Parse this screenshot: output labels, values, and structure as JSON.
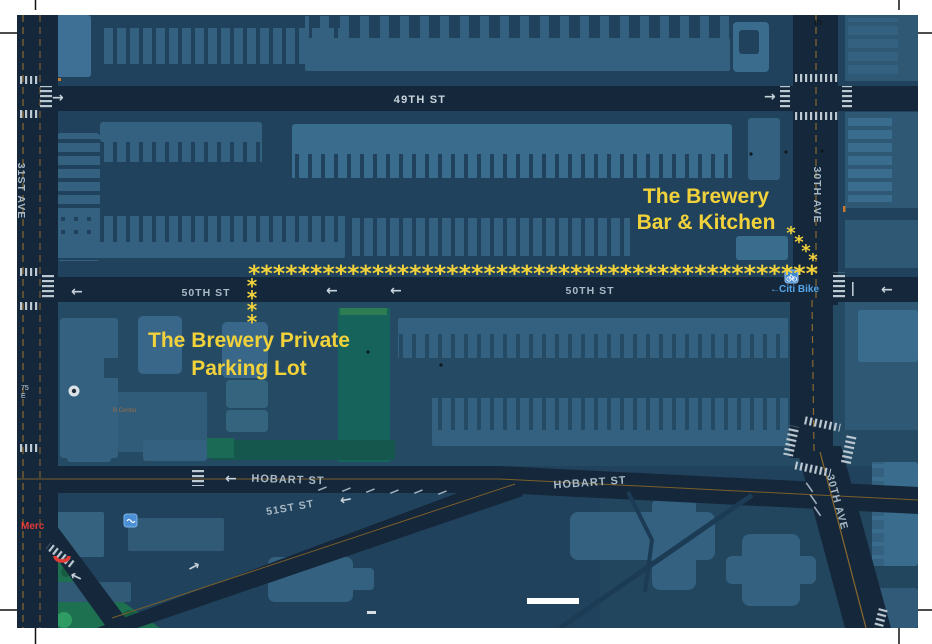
{
  "page": {
    "width": 932,
    "height": 644,
    "kind": "street-map-with-route-annotations"
  },
  "streets": {
    "st49": "49TH ST",
    "st50_west": "50TH ST",
    "st50_east": "50TH ST",
    "hobart_west": "HOBART ST",
    "hobart_east": "HOBART ST",
    "st51": "51ST ST",
    "ave31": "31ST AVE",
    "ave30_north": "30TH AVE",
    "ave30_south": "30TH AVE"
  },
  "annotations": {
    "destination_line1": "The Brewery",
    "destination_line2": "Bar & Kitchen",
    "parking_line1": "The Brewery Private",
    "parking_line2": "Parking Lot"
  },
  "route": {
    "star": "*",
    "trail_horizontal": "**********************************************"
  },
  "pois": {
    "citi_bike": "Citi Bike",
    "citi_arrow": "←",
    "merchant": "Merc",
    "small_label": "B Center",
    "address_75": "75",
    "address_suffix": "E",
    "subway_m": "m"
  },
  "arrows": {
    "left": "←",
    "right": "→"
  },
  "colors": {
    "route_yellow": "#F2D23B",
    "road": "#15273A",
    "land": "#21425C",
    "land_light": "#254A63",
    "building_mid": "#33617F",
    "building_light": "#3A6C8E",
    "building_lighter": "#3E7095",
    "building_dark": "#2E5874",
    "park_green": "#1B6B52",
    "park_teal": "#15564D",
    "destination_black": "#0D1014",
    "citi_blue": "#56A5E8",
    "alert_red": "#E23B36",
    "lane_orange": "#8A6A2E",
    "crosswalk": "#BCC9D2"
  }
}
